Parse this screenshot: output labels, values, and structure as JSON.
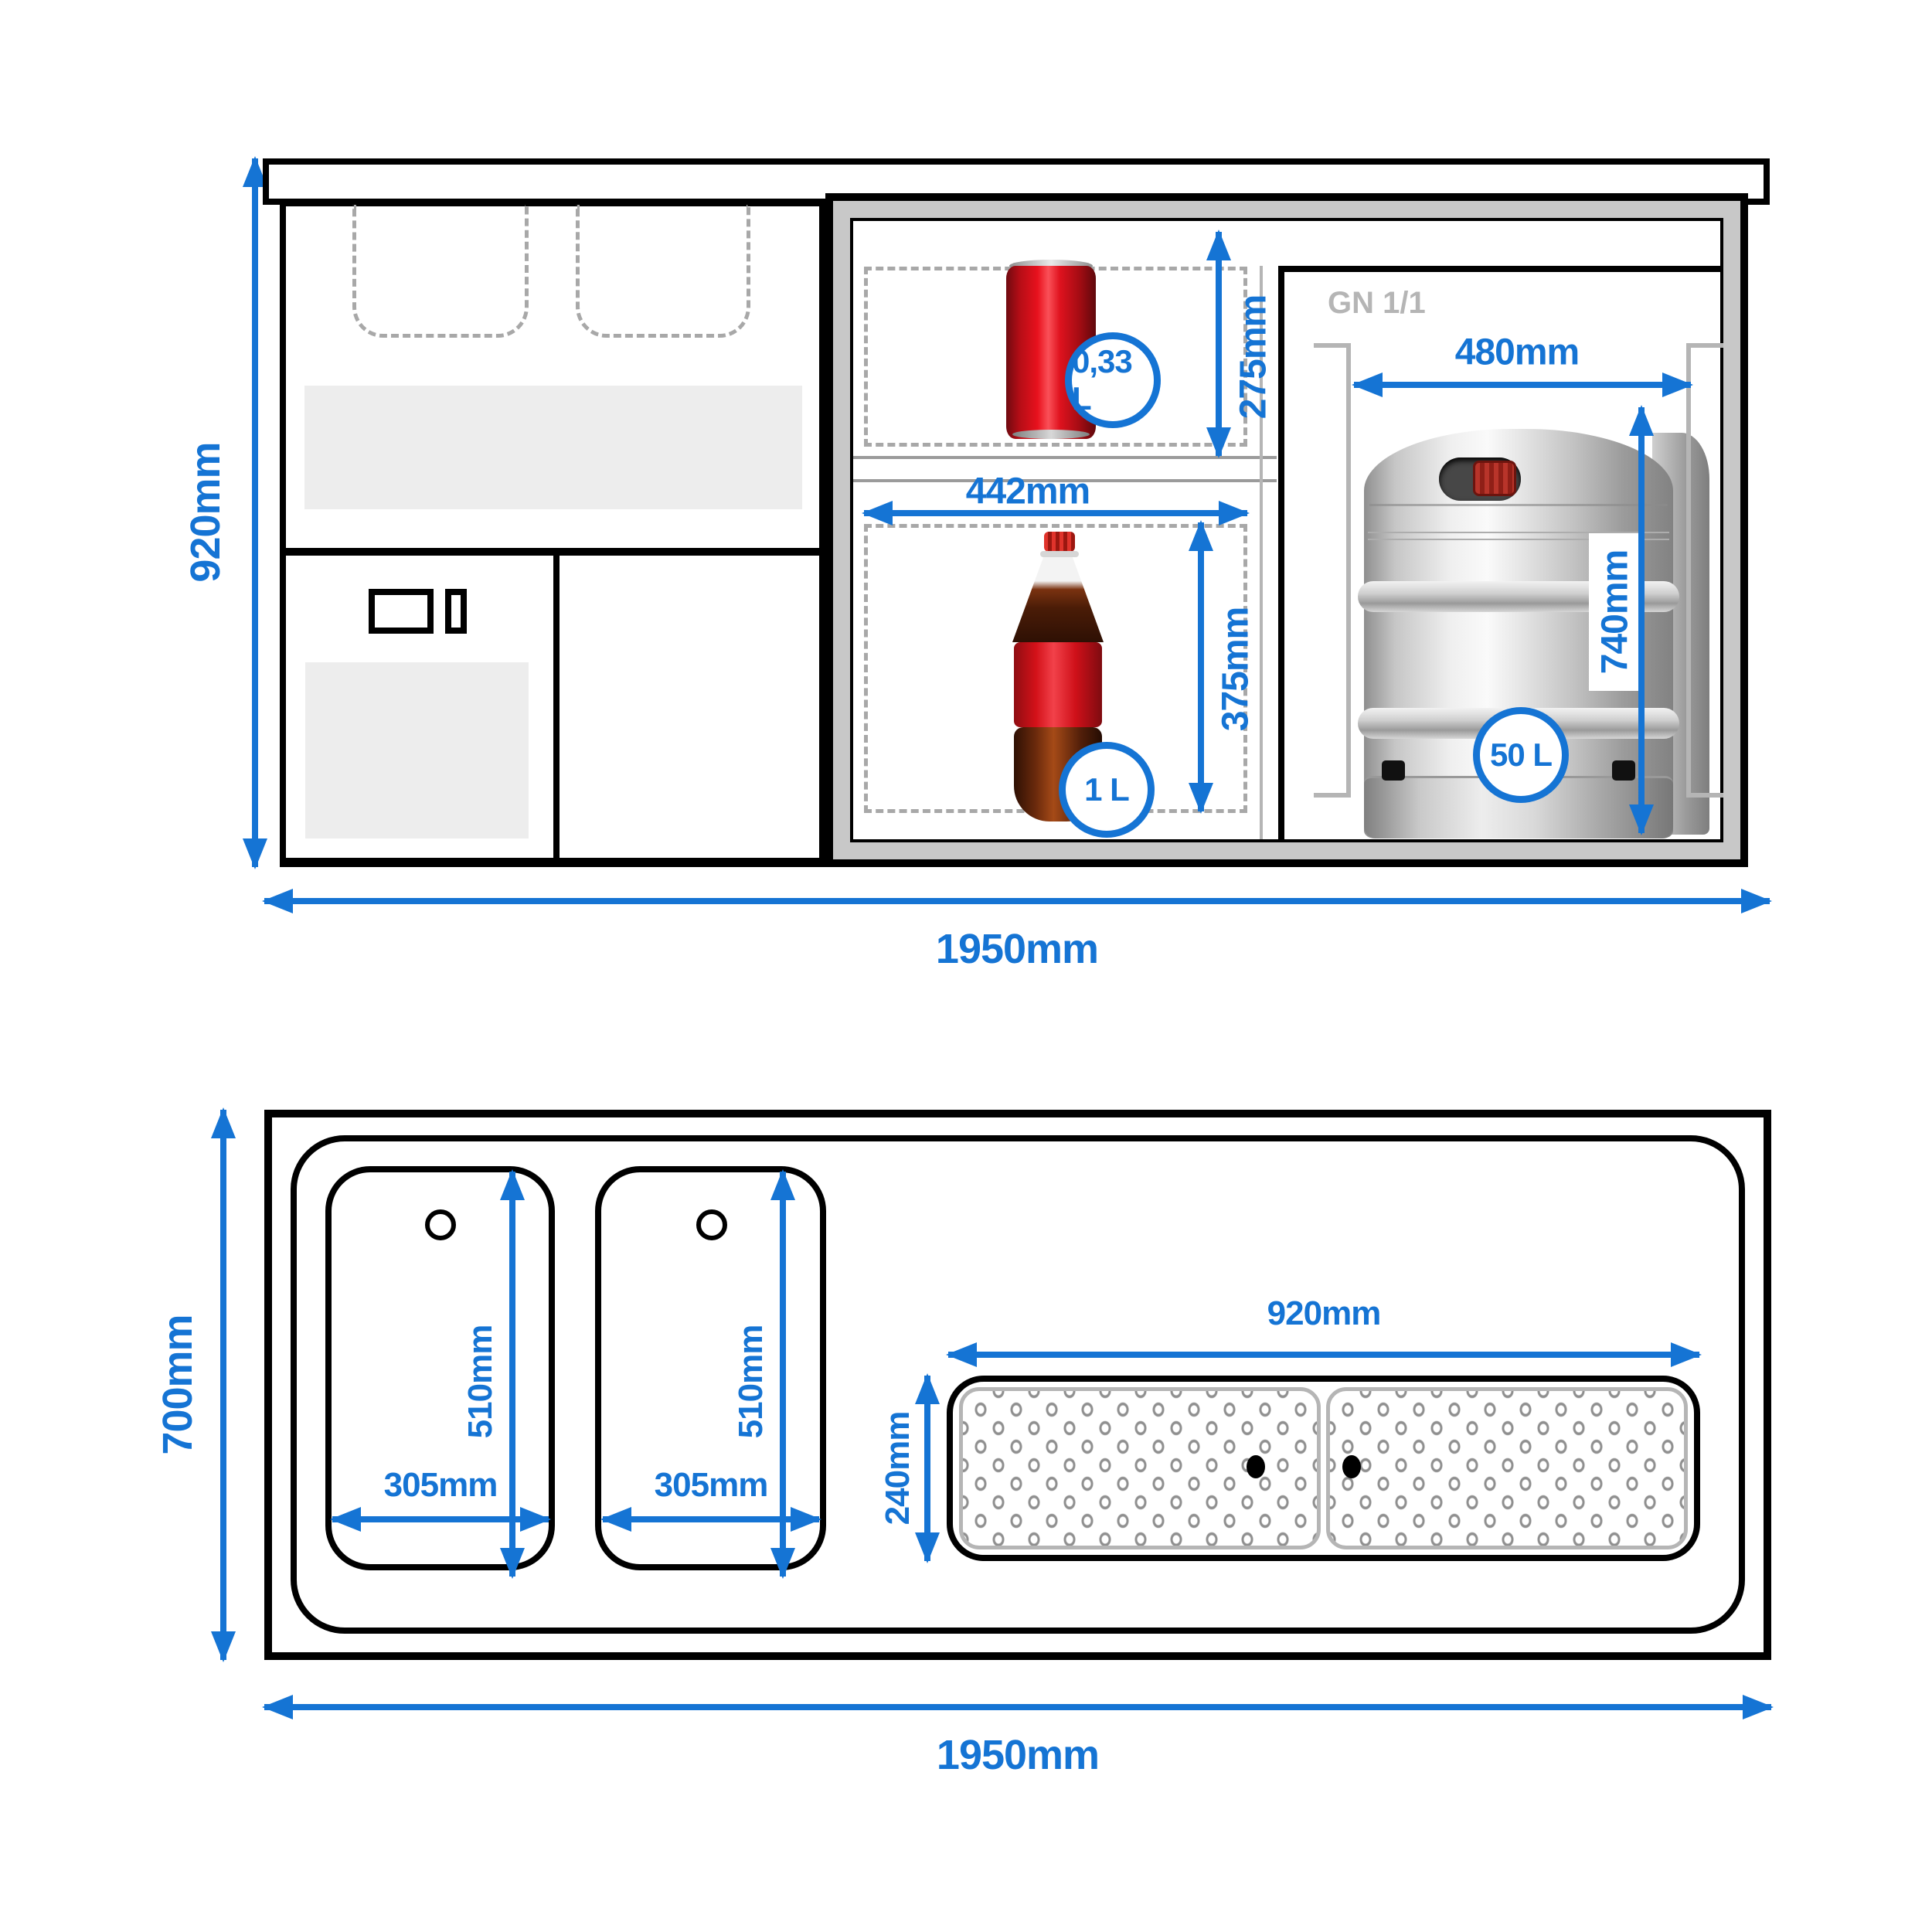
{
  "colors": {
    "accent": "#1574d4",
    "line": "#000000",
    "frame_gray": "#c8c8c8",
    "panel_gray": "#ededed",
    "dash_gray": "#a8a8a8"
  },
  "front_view": {
    "overall_height": "920mm",
    "overall_width": "1950mm",
    "fridge": {
      "can_compartment_height": "275mm",
      "can_volume": "0,33 L",
      "bottle_compartment_width": "442mm",
      "bottle_compartment_height": "375mm",
      "bottle_volume": "1 L",
      "keg_bay_label": "GN 1/1",
      "keg_bay_width": "480mm",
      "keg_height": "740mm",
      "keg_volume": "50 L"
    }
  },
  "plan_view": {
    "overall_depth": "700mm",
    "overall_width": "1950mm",
    "sinks": [
      {
        "length": "510mm",
        "width": "305mm"
      },
      {
        "length": "510mm",
        "width": "305mm"
      }
    ],
    "drainer": {
      "width": "920mm",
      "depth": "240mm"
    }
  }
}
